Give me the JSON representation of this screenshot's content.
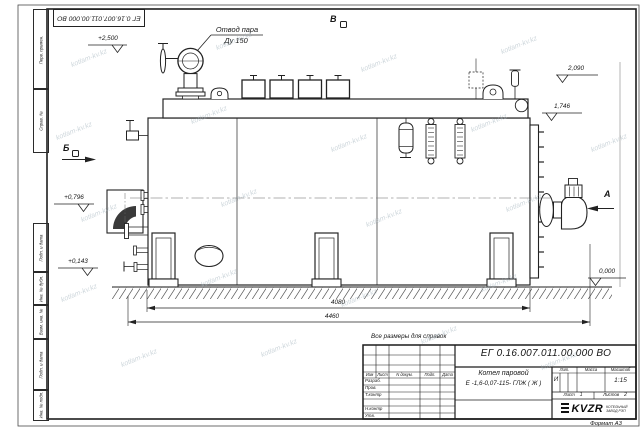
{
  "watermark": {
    "text": "kotlam-kv.kz"
  },
  "frame": {
    "top_doc_number": "ЕГ 0.16.007.011.00.000  ВО",
    "format_note": "Формат А3",
    "left_stamps": [
      "Перв. примен.",
      "Справ. №",
      "Подп. и дата",
      "Инв. № дубл.",
      "Взам. инв. №",
      "Подп. и дата",
      "Инв. № подл."
    ]
  },
  "note": {
    "text": "Все размеры для справок"
  },
  "drawing": {
    "callout_steam": {
      "line1": "Отвод пара",
      "line2": "Ду 150"
    },
    "views": {
      "v1": "В",
      "v2": "Б",
      "v3": "А"
    },
    "elevations": {
      "steam_outlet": "+2,500",
      "top_right": "2,090",
      "drum_top": "1,746",
      "left_mid": "+0,796",
      "left_low": "+0,143",
      "ground": "0,000"
    },
    "dimensions": {
      "shell_length": "4080",
      "overall_length": "4460"
    }
  },
  "title_block": {
    "doc_number": "ЕГ 0.16.007.011.00.000  ВО",
    "name_line1": "Котел паровой",
    "name_line2": "Е -1,6-0,07-115- ГЛЖ ( Ж )",
    "col_izm": "Изм",
    "col_list": "Лист",
    "col_docum": "N докум.",
    "col_podp": "Подп.",
    "col_data": "Дата",
    "row_razrab": "Разраб.",
    "row_prov": "Пров.",
    "row_tkontr": "Т.контр",
    "row_nkontr": "Н.контр",
    "row_utv": "Утв.",
    "lit_header": "Лит.",
    "mass_header": "Масса",
    "scale_header": "Масштаб",
    "lit_value": "И",
    "scale_value": "1:15",
    "sheet_label": "Лист",
    "sheet_value": "1",
    "sheets_label": "Листов",
    "sheets_value": "2",
    "logo": {
      "brand": "KVZR",
      "sub1": "КОТЕЛЬНЫЙ",
      "sub2": "ЗАВОД РЭП"
    }
  }
}
